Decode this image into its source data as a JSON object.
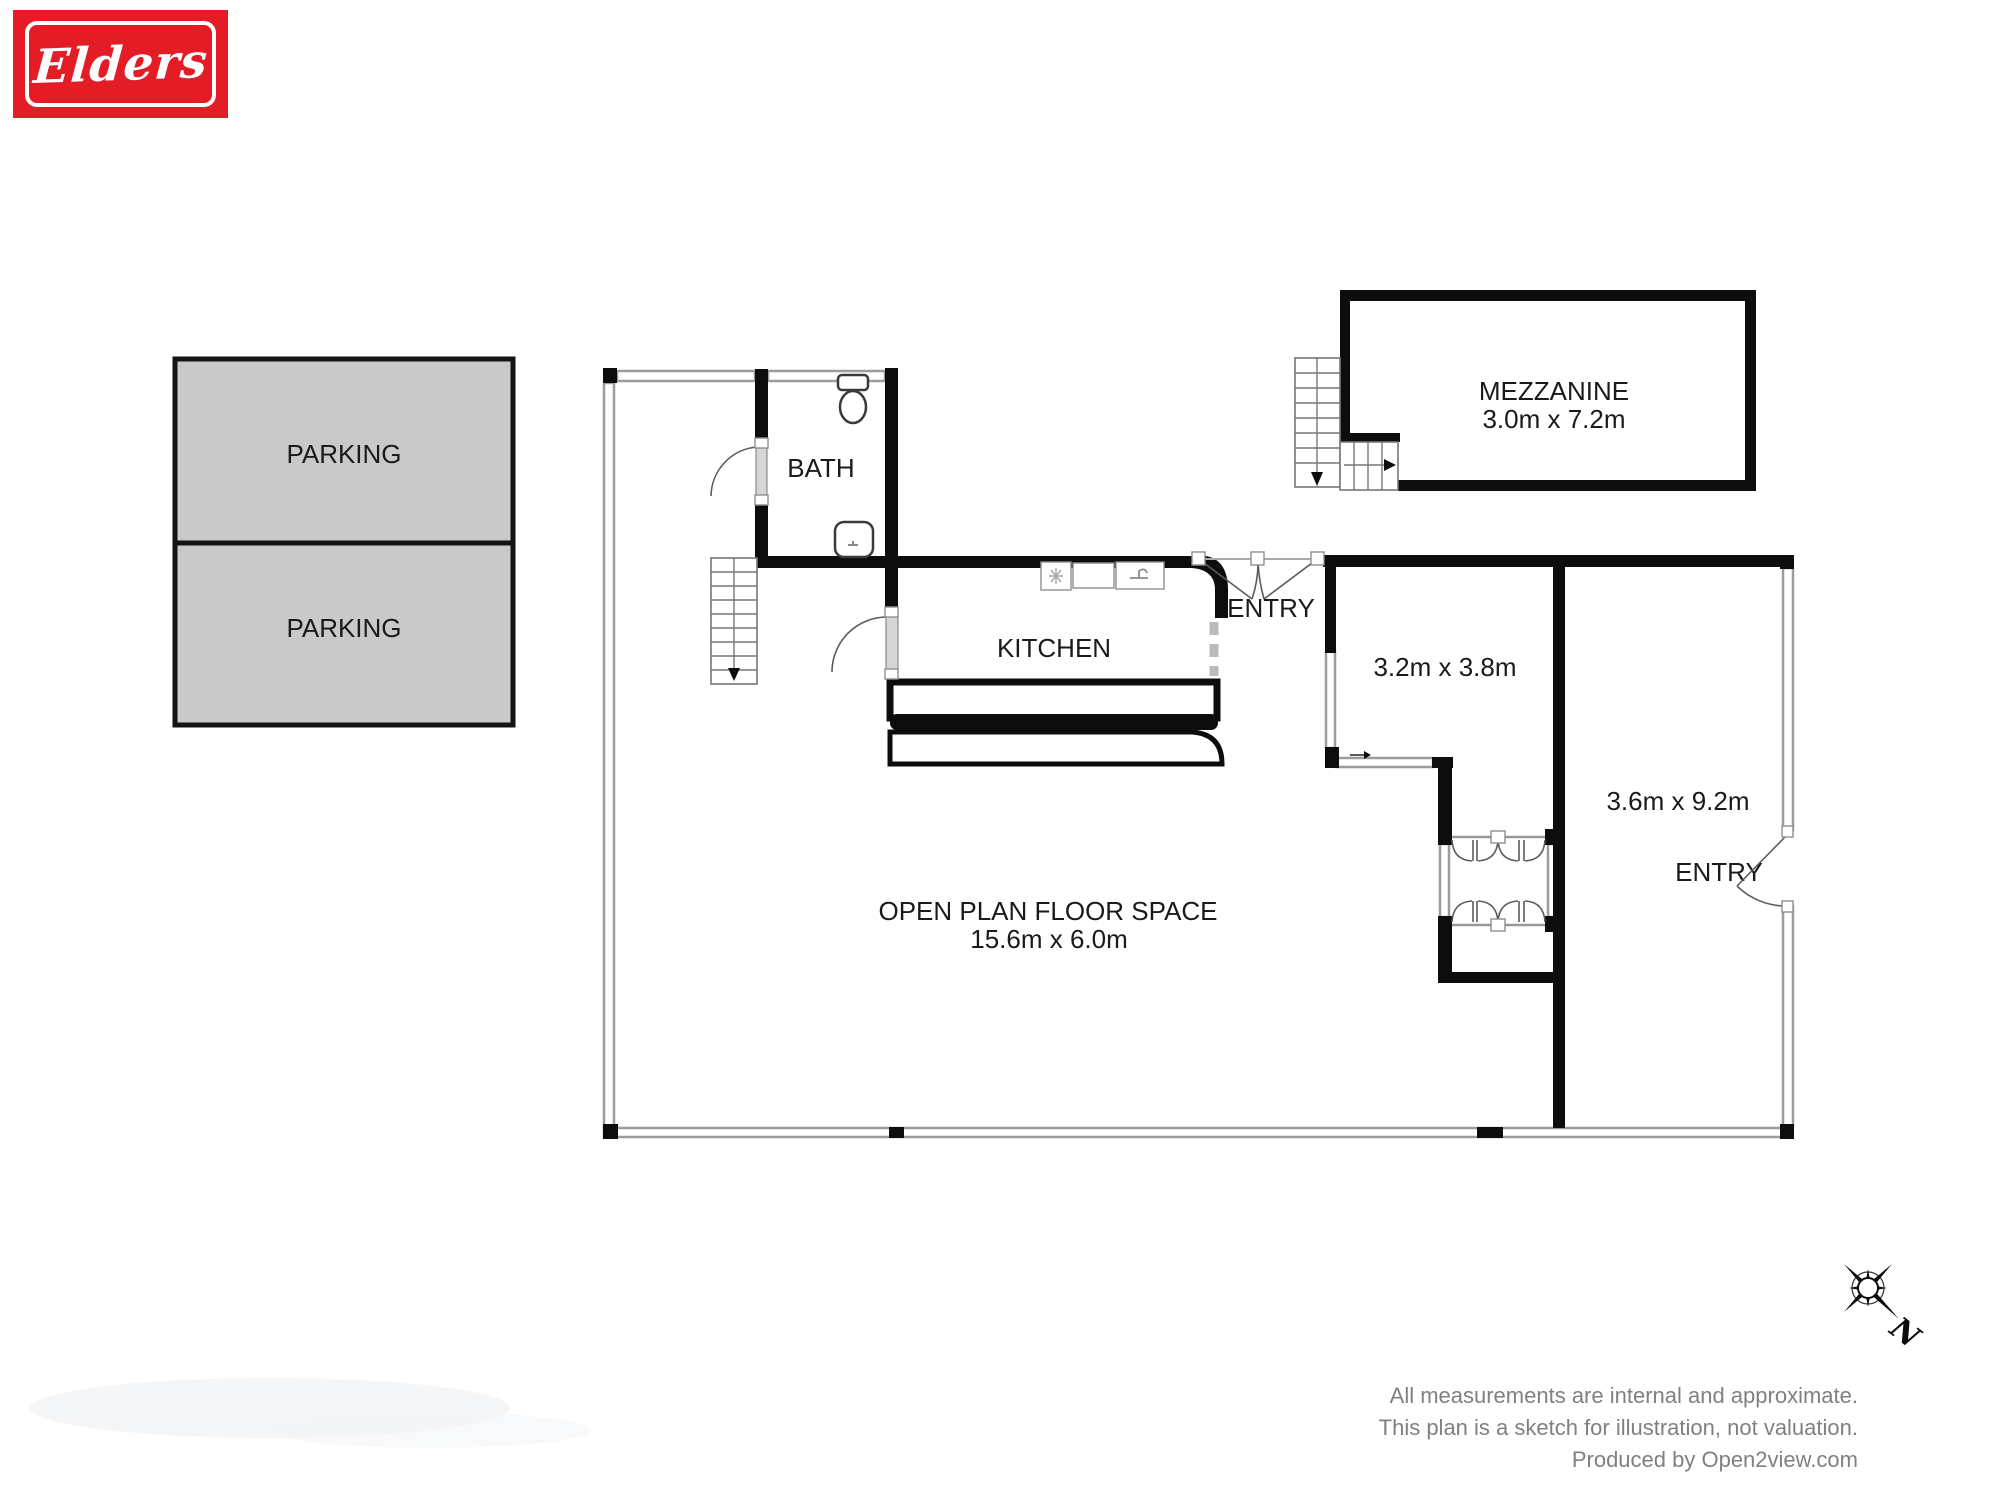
{
  "logo": {
    "brand": "Elders"
  },
  "parking": {
    "space1": "PARKING",
    "space2": "PARKING"
  },
  "plan": {
    "bath": {
      "label": "BATH"
    },
    "kitchen": {
      "label": "KITCHEN"
    },
    "entry_top": {
      "label": "ENTRY"
    },
    "entry_right": {
      "label": "ENTRY"
    },
    "mezzanine": {
      "label": "MEZZANINE",
      "dims": "3.0m x 7.2m"
    },
    "room_a": {
      "dims": "3.2m x 3.8m"
    },
    "room_b": {
      "dims": "3.6m x 9.2m"
    },
    "open_plan": {
      "label": "OPEN PLAN FLOOR SPACE",
      "dims": "15.6m x 6.0m"
    }
  },
  "compass": {
    "north": "N"
  },
  "footer": {
    "line1": "All measurements are internal and approximate.",
    "line2": "This plan is a sketch for illustration, not valuation.",
    "line3": "Produced by Open2view.com"
  },
  "colors": {
    "wall": "#0d0d0d",
    "window_stroke": "#9c9c9c",
    "parking_fill": "#c9c9c9",
    "brand_red": "#e31c25",
    "footer_gray": "#808080"
  }
}
